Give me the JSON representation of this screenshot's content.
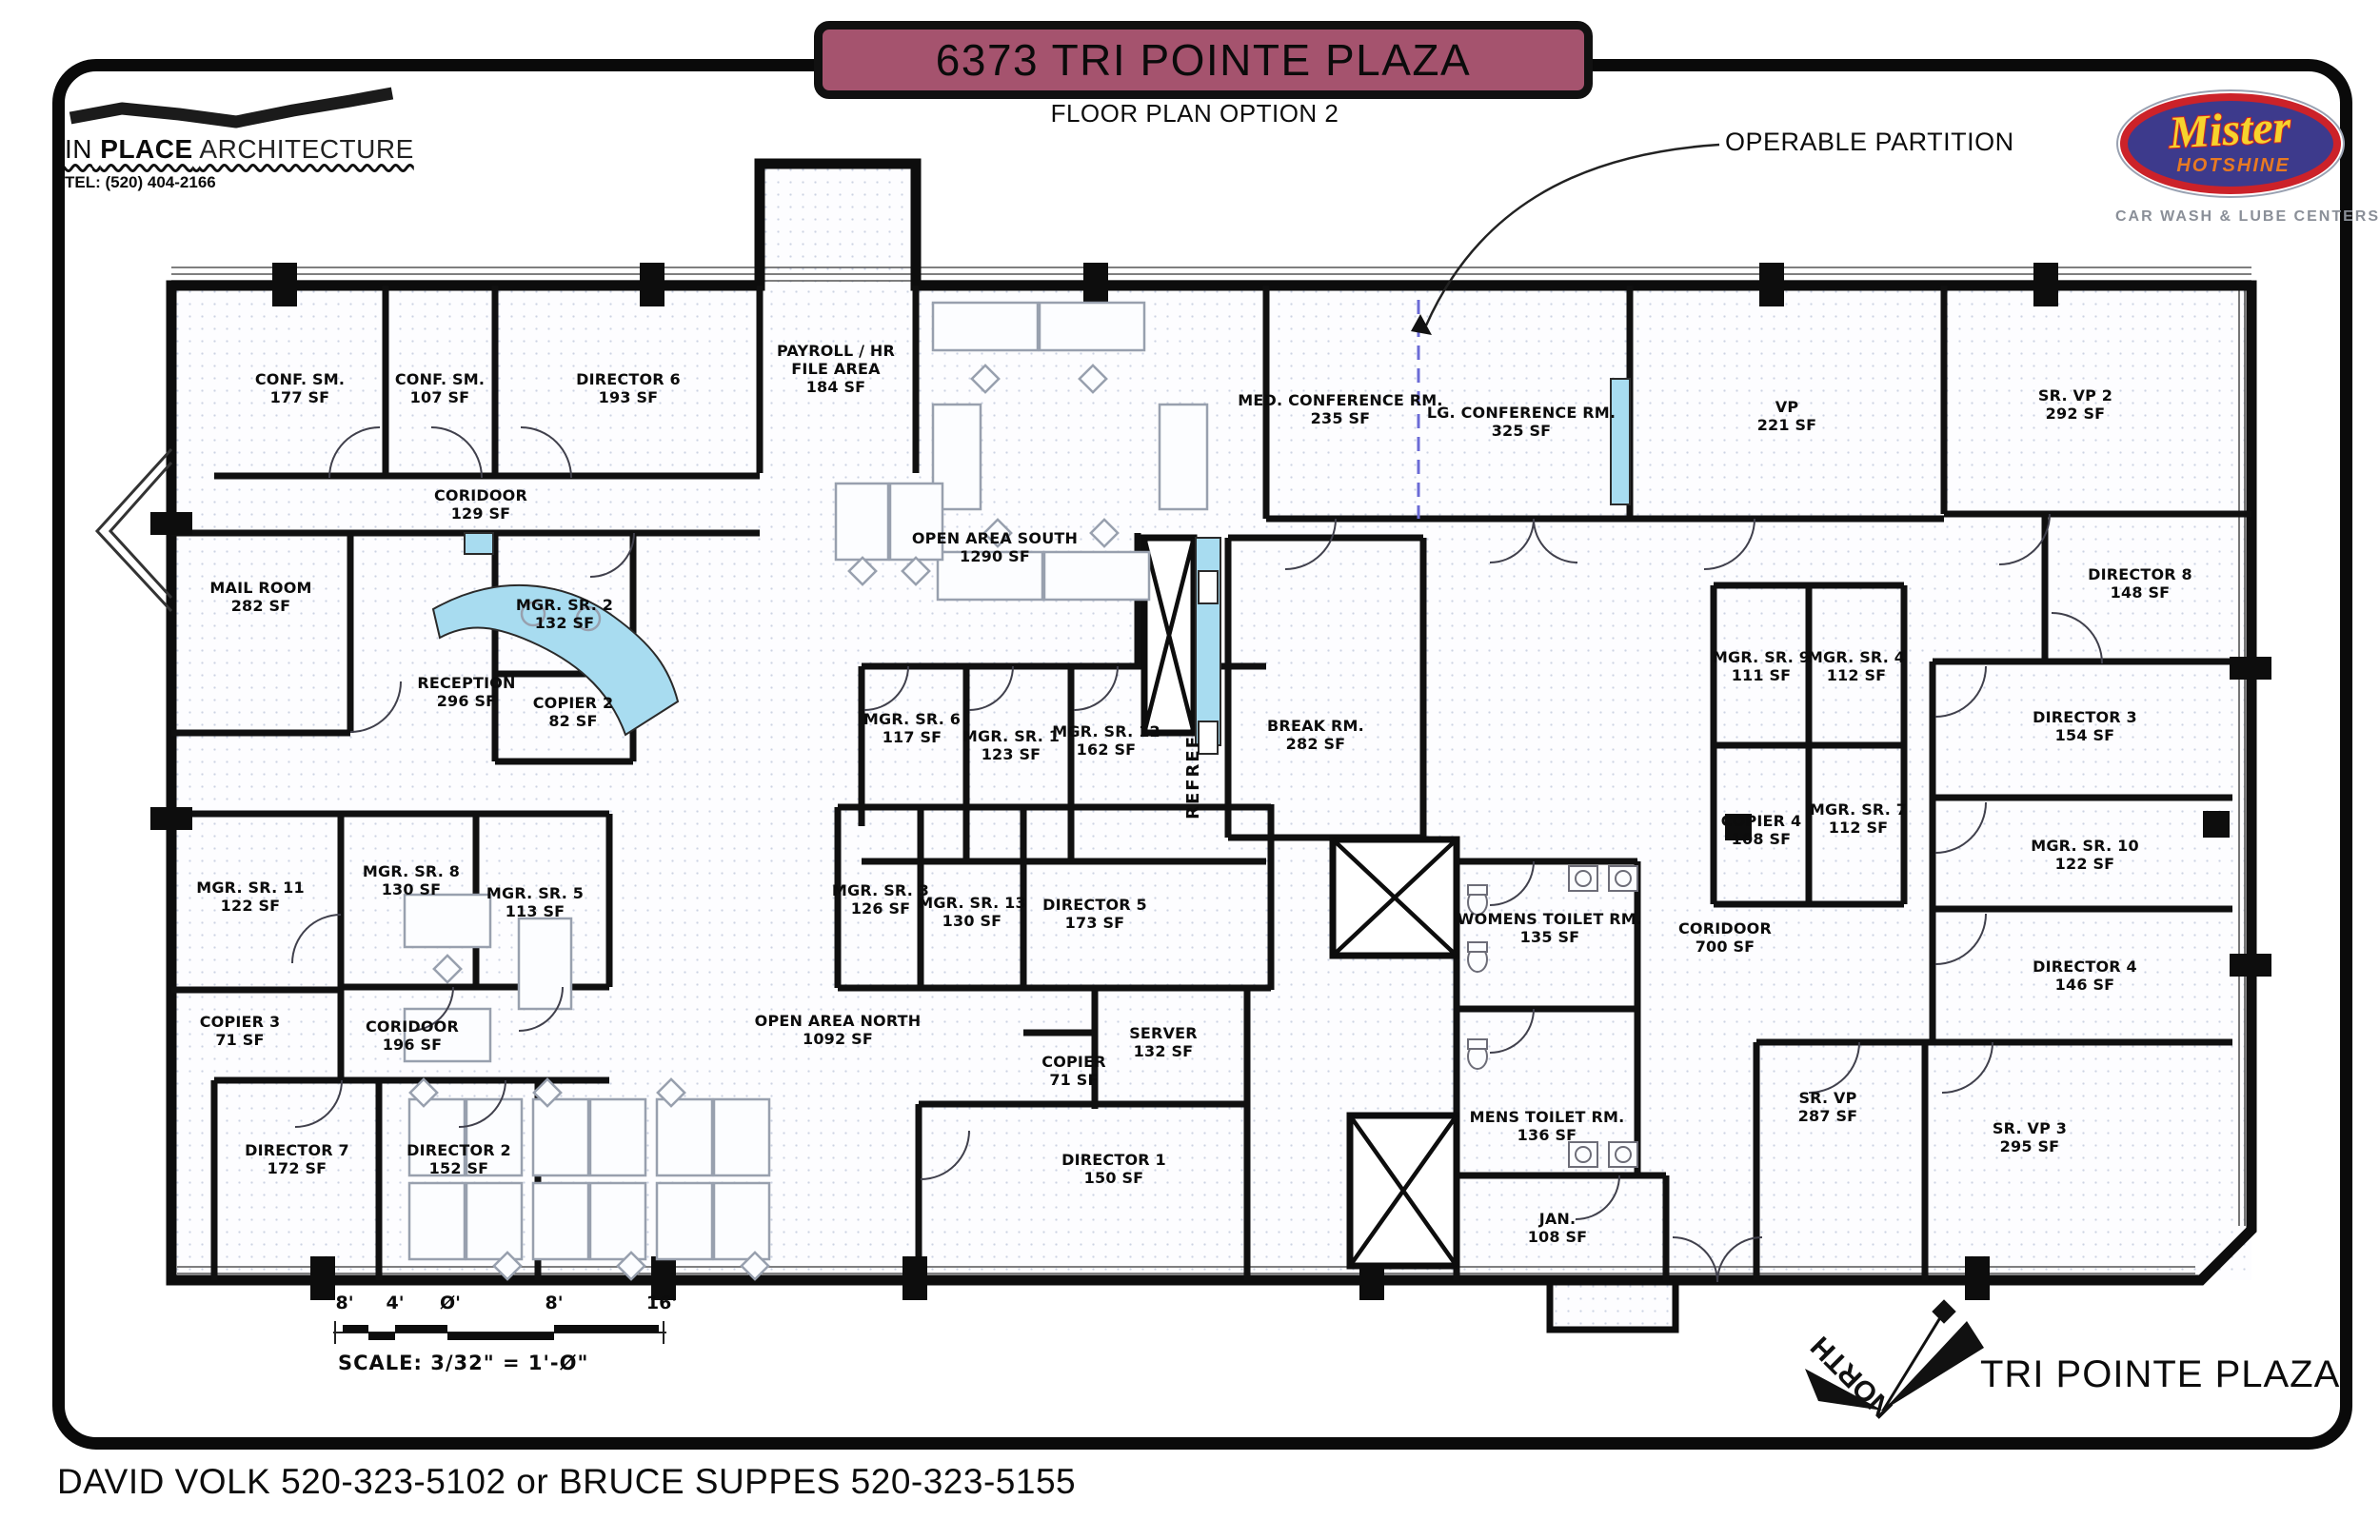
{
  "header": {
    "architect": {
      "part1": "IN",
      "part2": "PLACE",
      "part3": "ARCHITECTURE",
      "tel": "TEL: (520) 404-2166"
    },
    "banner_title": "6373 TRI POINTE PLAZA",
    "subtitle": "FLOOR PLAN OPTION 2",
    "brand": {
      "name_top": "Mister",
      "name_bottom": "HOTSHINE",
      "tagline": "CAR WASH & LUBE CENTERS"
    }
  },
  "annotations": {
    "operable_partition": "OPERABLE PARTITION",
    "ref_label": "REFREF",
    "north_label": "NORTH",
    "plaza_label": "TRI POINTE PLAZA",
    "scale_ticks": [
      "8'",
      "4'",
      "Ø'",
      "8'",
      "16'"
    ],
    "scale_text": "SCALE: 3/32\" = 1'-Ø\"",
    "contact_line": "DAVID VOLK  520-323-5102  or BRUCE SUPPES  520-323-5155"
  },
  "colors": {
    "banner_maroon": "#A5536E",
    "partition_blue": "#6b6bd6",
    "desk_cyan": "#A8DCF0",
    "logo_blue": "#3D3A8C",
    "logo_red": "#CC2229",
    "logo_yellow": "#F6D32D",
    "logo_orange": "#E87A22",
    "logo_gray": "#8a8f98"
  },
  "rooms": [
    {
      "name": "CONF. SM.",
      "area": "177 SF"
    },
    {
      "name": "CONF. SM.",
      "area": "107 SF"
    },
    {
      "name": "DIRECTOR 6",
      "area": "193 SF"
    },
    {
      "name": "PAYROLL / HR FILE AREA",
      "area": "184 SF"
    },
    {
      "name": "OPEN AREA SOUTH",
      "area": "1290 SF"
    },
    {
      "name": "MED. CONFERENCE RM.",
      "area": "235 SF"
    },
    {
      "name": "LG. CONFERENCE RM.",
      "area": "325 SF"
    },
    {
      "name": "VP",
      "area": "221 SF"
    },
    {
      "name": "SR. VP 2",
      "area": "292 SF"
    },
    {
      "name": "CORIDOOR",
      "area": "129 SF"
    },
    {
      "name": "MAIL ROOM",
      "area": "282 SF"
    },
    {
      "name": "RECEPTION",
      "area": "296 SF"
    },
    {
      "name": "MGR. SR. 2",
      "area": "132 SF"
    },
    {
      "name": "COPIER 2",
      "area": "82 SF"
    },
    {
      "name": "MGR. SR. 6",
      "area": "117 SF"
    },
    {
      "name": "MGR. SR. 1",
      "area": "123 SF"
    },
    {
      "name": "MGR. SR. 12",
      "area": "162 SF"
    },
    {
      "name": "BREAK RM.",
      "area": "282 SF"
    },
    {
      "name": "MGR. SR. 9",
      "area": "111 SF"
    },
    {
      "name": "MGR. SR. 4",
      "area": "112 SF"
    },
    {
      "name": "MGR. SR. 7",
      "area": "112 SF"
    },
    {
      "name": "COPIER 4",
      "area": "108 SF"
    },
    {
      "name": "CORIDOOR",
      "area": "700 SF"
    },
    {
      "name": "DIRECTOR 8",
      "area": "148 SF"
    },
    {
      "name": "DIRECTOR 3",
      "area": "154 SF"
    },
    {
      "name": "MGR. SR. 10",
      "area": "122 SF"
    },
    {
      "name": "DIRECTOR 4",
      "area": "146 SF"
    },
    {
      "name": "MGR. SR. 11",
      "area": "122 SF"
    },
    {
      "name": "MGR. SR. 8",
      "area": "130 SF"
    },
    {
      "name": "MGR. SR. 5",
      "area": "113 SF"
    },
    {
      "name": "COPIER 3",
      "area": "71 SF"
    },
    {
      "name": "CORIDOOR",
      "area": "196 SF"
    },
    {
      "name": "OPEN AREA NORTH",
      "area": "1092 SF"
    },
    {
      "name": "MGR. SR. 3",
      "area": "126 SF"
    },
    {
      "name": "MGR. SR. 13",
      "area": "130 SF"
    },
    {
      "name": "DIRECTOR 5",
      "area": "173 SF"
    },
    {
      "name": "COPIER",
      "area": "71 SF"
    },
    {
      "name": "SERVER",
      "area": "132 SF"
    },
    {
      "name": "DIRECTOR 1",
      "area": "150 SF"
    },
    {
      "name": "WOMENS TOILET RM.",
      "area": "135 SF"
    },
    {
      "name": "MENS TOILET RM.",
      "area": "136 SF"
    },
    {
      "name": "JAN.",
      "area": "108 SF"
    },
    {
      "name": "SR. VP",
      "area": "287 SF"
    },
    {
      "name": "SR. VP 3",
      "area": "295 SF"
    },
    {
      "name": "DIRECTOR 7",
      "area": "172 SF"
    },
    {
      "name": "DIRECTOR 2",
      "area": "152 SF"
    }
  ]
}
